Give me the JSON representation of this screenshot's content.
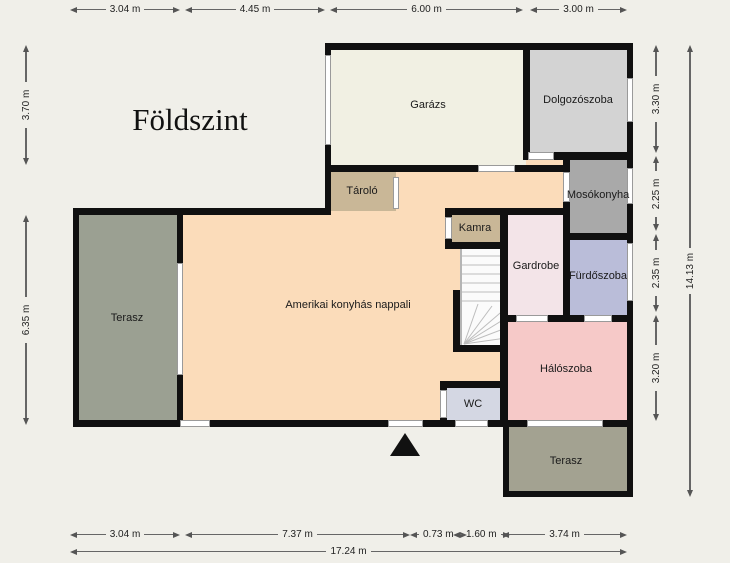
{
  "title": "Földszint",
  "rooms": {
    "garazs": {
      "label": "Garázs",
      "color": "#f1f0e3"
    },
    "dolgozoszoba": {
      "label": "Dolgozószoba",
      "color": "#d3d3d3"
    },
    "tarolo": {
      "label": "Tároló",
      "color": "#c9b797"
    },
    "mosokonyha": {
      "label": "Mosókonyha",
      "color": "#a9a9a9"
    },
    "kamra": {
      "label": "Kamra",
      "color": "#c9b797"
    },
    "gardrobe": {
      "label": "Gardrobe",
      "color": "#f3e4e8"
    },
    "furdoszoba": {
      "label": "Fürdőszoba",
      "color": "#babdd9"
    },
    "nappali": {
      "label": "Amerikai konyhás nappali",
      "color": "#fbdcba"
    },
    "haloszoba": {
      "label": "Hálószoba",
      "color": "#f6c9c8"
    },
    "wc": {
      "label": "WC",
      "color": "#d4d7e3"
    },
    "terasz_oldal": {
      "label": "Terasz",
      "color": "#9ba092"
    },
    "terasz_also": {
      "label": "Terasz",
      "color": "#a3a291"
    }
  },
  "dimensions": {
    "top": [
      "3.04 m",
      "4.45 m",
      "6.00 m",
      "3.00 m"
    ],
    "left": [
      "3.70 m",
      "6.35 m"
    ],
    "right": [
      "3.30 m",
      "2.25 m",
      "2.35 m",
      "3.20 m"
    ],
    "right_total": "14.13 m",
    "bottom": [
      "3.04 m",
      "7.37 m",
      "0.73 m",
      "1.60 m",
      "3.74 m"
    ],
    "bottom_total": "17.24 m"
  },
  "colors": {
    "background": "#f0efe9",
    "wall": "#101010",
    "window": "#ffffff",
    "dimension_text": "#222222"
  }
}
